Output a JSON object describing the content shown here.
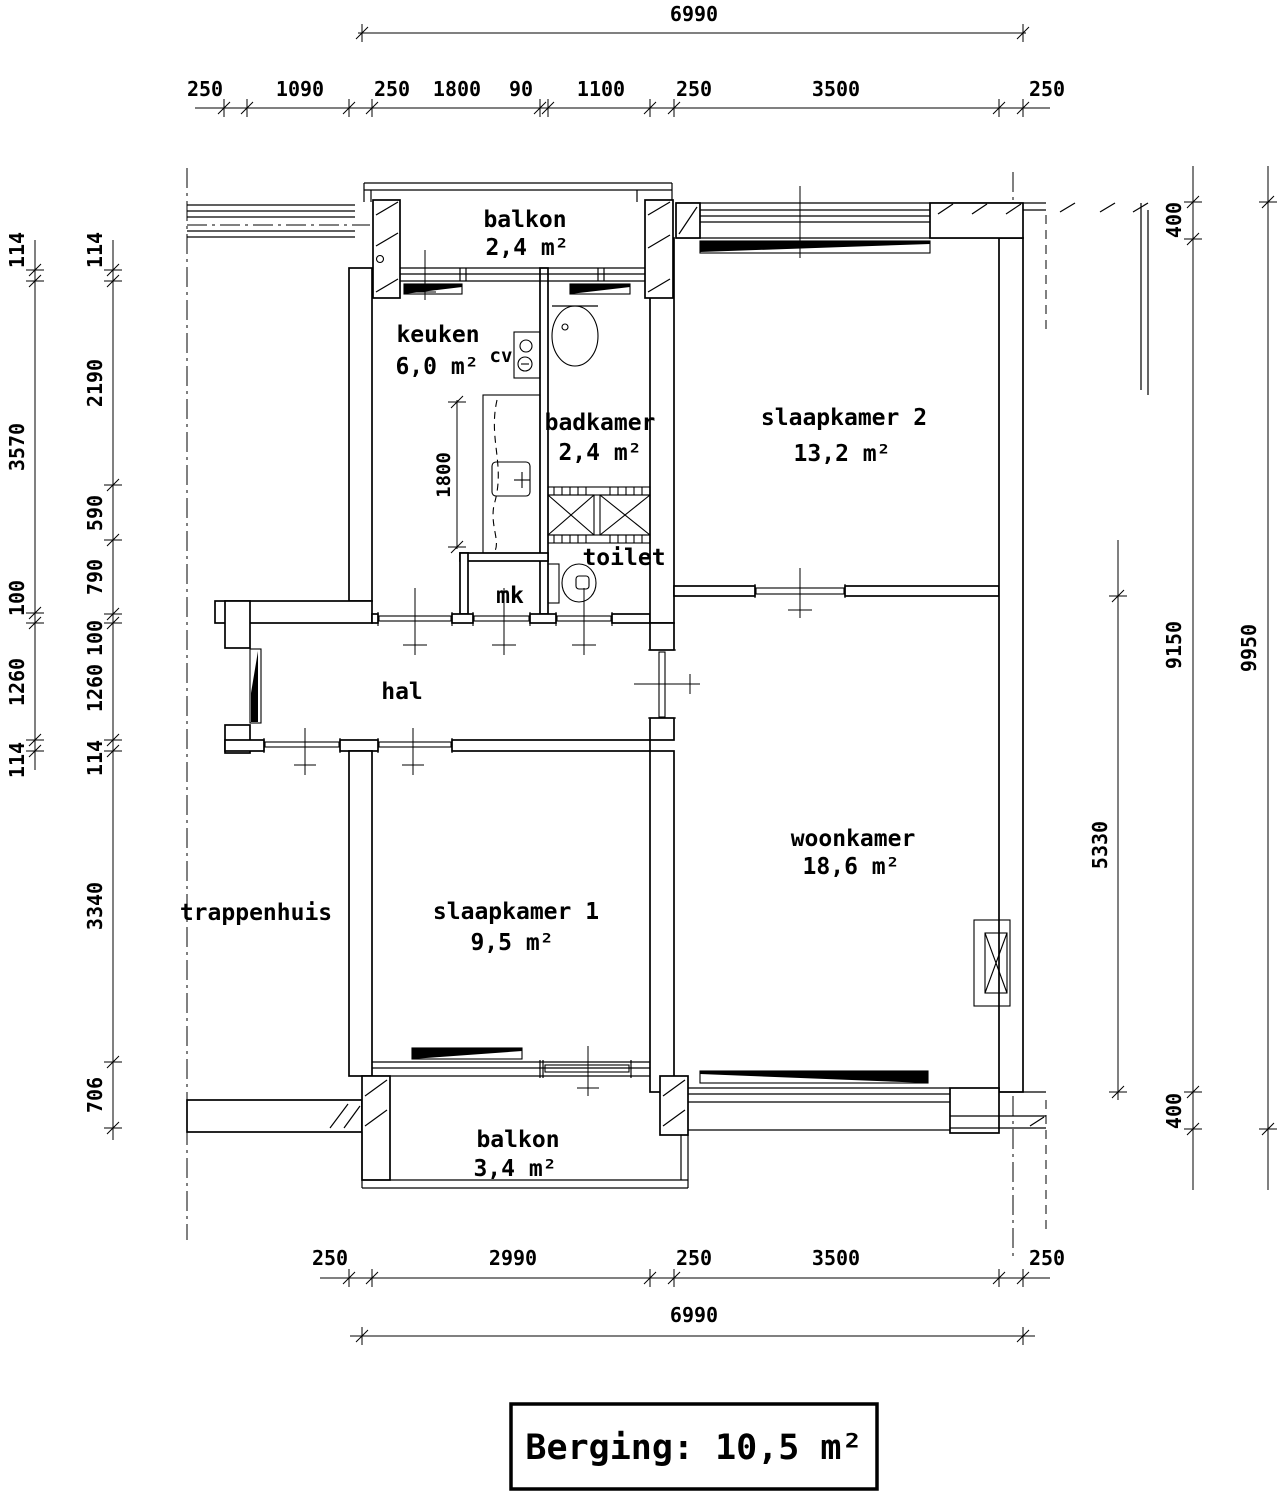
{
  "rooms": {
    "balkon_noord": {
      "name": "balkon",
      "area": "2,4 m²"
    },
    "keuken": {
      "name": "keuken",
      "area": "6,0 m²"
    },
    "badkamer": {
      "name": "badkamer",
      "area": "2,4 m²"
    },
    "slaapkamer2": {
      "name": "slaapkamer 2",
      "area": "13,2 m²"
    },
    "toilet": {
      "name": "toilet"
    },
    "mk": {
      "name": "mk"
    },
    "cv": {
      "name": "cv"
    },
    "hal": {
      "name": "hal"
    },
    "trappenhuis": {
      "name": "trappenhuis"
    },
    "slaapkamer1": {
      "name": "slaapkamer 1",
      "area": "9,5 m²"
    },
    "woonkamer": {
      "name": "woonkamer",
      "area": "18,6 m²"
    },
    "balkon_zuid": {
      "name": "balkon",
      "area": "3,4 m²"
    }
  },
  "dims": {
    "top_total": "6990",
    "top_chain": [
      "250",
      "1090",
      "250",
      "1800",
      "90",
      "1100",
      "250",
      "3500",
      "250"
    ],
    "left_outer": [
      "114",
      "3570",
      "100",
      "1260",
      "114"
    ],
    "left_inner": [
      "114",
      "2190",
      "590",
      "790",
      "100",
      "1260",
      "114",
      "3340",
      "706"
    ],
    "right_woonkamer_depth": "5330",
    "right_chain": [
      "400",
      "9150",
      "400"
    ],
    "right_total": "9950",
    "bottom_chain": [
      "250",
      "2990",
      "250",
      "3500",
      "250"
    ],
    "bottom_total": "6990",
    "counter_length": "1800"
  },
  "footer": {
    "berging": "Berging: 10,5 m²"
  },
  "colors": {
    "line": "#000000",
    "background": "#ffffff"
  }
}
